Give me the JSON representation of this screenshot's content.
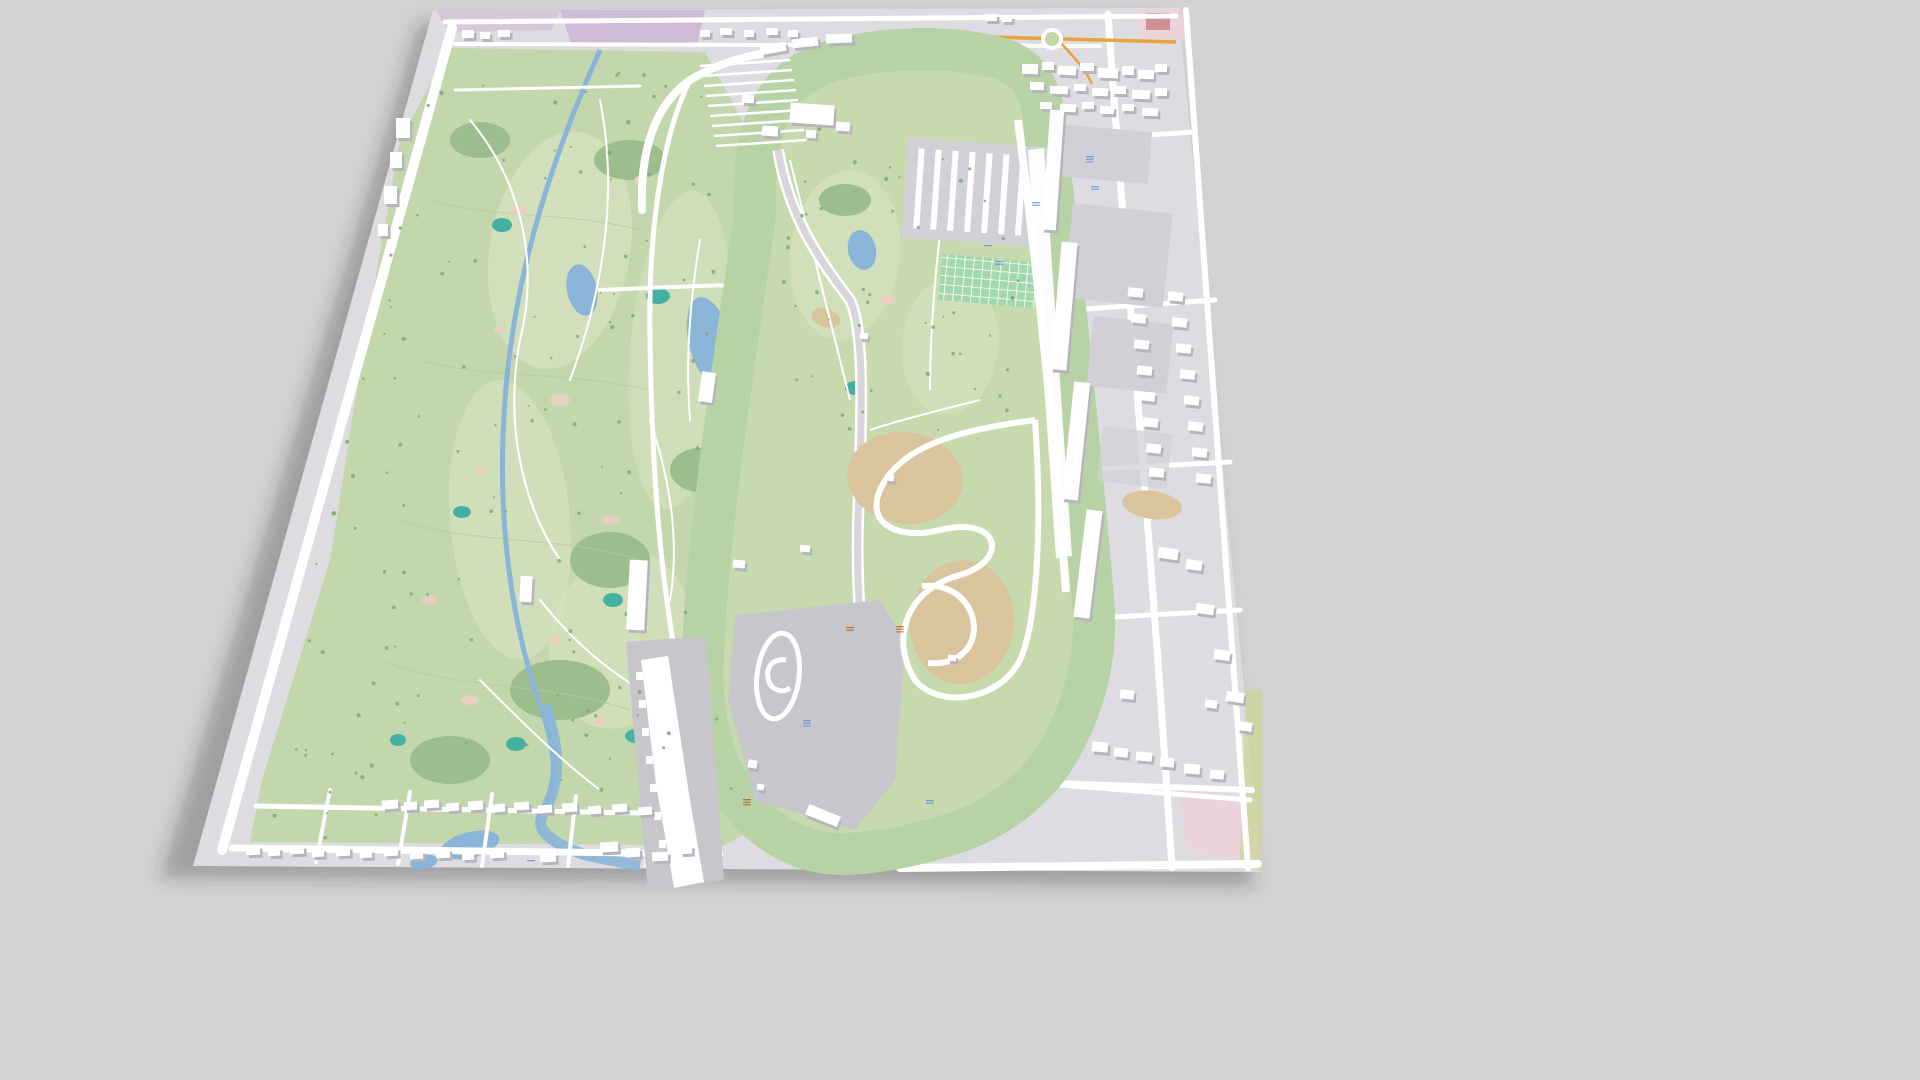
{
  "scene": {
    "title": "3D aerial perspective map — speedway and golf course complex",
    "background": "#d2d2d3"
  },
  "palette": {
    "bg": "#d2d2d3",
    "shadow": "rgba(45,45,50,0.30)",
    "pavement": "#dedce0",
    "pavementDark": "#d2d0d6",
    "paddock": "#c7c6cc",
    "grass": "#c2d7ac",
    "grassLight": "#d6e3bf",
    "grassInfield": "#c6daae",
    "verge": "#b7d2a4",
    "forest": "#9cbd8e",
    "treeGreen": "#7fa878",
    "contour": "#b3caa0",
    "water": "#8ab5d8",
    "teal": "#44b0a2",
    "sand": "#e8d0c0",
    "dirt": "#d9c49e",
    "purple": "#cfbbd5",
    "pinkZone": "#ead3da",
    "redBuilding": "#cf8f93",
    "orangeRoad": "#e8a33d",
    "road": "#ffffff",
    "trackAsphalt": "#d8d6db",
    "buildingTop": "#ffffff",
    "buildingSide": "#b6b5bc",
    "parkingGreen": "#a5d7ae",
    "labelBlue": "#6b8fd4",
    "labelRed": "#b5651d",
    "limeStrip": "#cdd69a"
  },
  "features": {
    "map_plane": "tilted 3d map tile",
    "west_area": "golf course with creek and ponds",
    "center": "oval race track with green verges",
    "infield_north": "infield golf holes and museum buildings",
    "infield_south": "paddock, skid pad and dirt road course",
    "east_area": "parking lots, garages, grandstands and streets",
    "south_area": "residential streets with houses"
  },
  "buildings": [
    {
      "x": 1022,
      "y": 64,
      "w": 16,
      "h": 10,
      "r": 2
    },
    {
      "x": 1042,
      "y": 62,
      "w": 12,
      "h": 8,
      "r": 0
    },
    {
      "x": 1058,
      "y": 66,
      "w": 18,
      "h": 9,
      "r": 3
    },
    {
      "x": 1080,
      "y": 63,
      "w": 14,
      "h": 8,
      "r": 0
    },
    {
      "x": 1098,
      "y": 68,
      "w": 20,
      "h": 10,
      "r": 2
    },
    {
      "x": 1122,
      "y": 66,
      "w": 12,
      "h": 9,
      "r": 0
    },
    {
      "x": 1138,
      "y": 70,
      "w": 16,
      "h": 9,
      "r": 2
    },
    {
      "x": 1155,
      "y": 64,
      "w": 12,
      "h": 8,
      "r": 0
    },
    {
      "x": 1030,
      "y": 82,
      "w": 14,
      "h": 8,
      "r": 1
    },
    {
      "x": 1050,
      "y": 86,
      "w": 18,
      "h": 8,
      "r": 2
    },
    {
      "x": 1074,
      "y": 84,
      "w": 12,
      "h": 7,
      "r": 0
    },
    {
      "x": 1092,
      "y": 88,
      "w": 16,
      "h": 8,
      "r": 2
    },
    {
      "x": 1112,
      "y": 86,
      "w": 14,
      "h": 8,
      "r": 1
    },
    {
      "x": 1132,
      "y": 90,
      "w": 18,
      "h": 9,
      "r": 2
    },
    {
      "x": 1155,
      "y": 88,
      "w": 12,
      "h": 8,
      "r": 0
    },
    {
      "x": 1040,
      "y": 102,
      "w": 12,
      "h": 7,
      "r": 1
    },
    {
      "x": 1060,
      "y": 104,
      "w": 16,
      "h": 8,
      "r": 2
    },
    {
      "x": 1082,
      "y": 102,
      "w": 12,
      "h": 7,
      "r": 0
    },
    {
      "x": 1100,
      "y": 106,
      "w": 14,
      "h": 8,
      "r": 2
    },
    {
      "x": 1122,
      "y": 104,
      "w": 12,
      "h": 7,
      "r": 1
    },
    {
      "x": 1142,
      "y": 108,
      "w": 16,
      "h": 8,
      "r": 2
    },
    {
      "x": 985,
      "y": 14,
      "w": 12,
      "h": 7,
      "r": 0
    },
    {
      "x": 1002,
      "y": 16,
      "w": 10,
      "h": 6,
      "r": 0
    },
    {
      "x": 1128,
      "y": 288,
      "w": 15,
      "h": 9,
      "r": 6
    },
    {
      "x": 1131,
      "y": 314,
      "w": 15,
      "h": 9,
      "r": 6
    },
    {
      "x": 1134,
      "y": 340,
      "w": 15,
      "h": 9,
      "r": 6
    },
    {
      "x": 1137,
      "y": 366,
      "w": 15,
      "h": 9,
      "r": 6
    },
    {
      "x": 1140,
      "y": 392,
      "w": 15,
      "h": 9,
      "r": 6
    },
    {
      "x": 1143,
      "y": 418,
      "w": 15,
      "h": 9,
      "r": 6
    },
    {
      "x": 1146,
      "y": 444,
      "w": 15,
      "h": 9,
      "r": 6
    },
    {
      "x": 1149,
      "y": 468,
      "w": 15,
      "h": 9,
      "r": 6
    },
    {
      "x": 1168,
      "y": 292,
      "w": 15,
      "h": 9,
      "r": 6
    },
    {
      "x": 1172,
      "y": 318,
      "w": 15,
      "h": 9,
      "r": 6
    },
    {
      "x": 1176,
      "y": 344,
      "w": 15,
      "h": 9,
      "r": 6
    },
    {
      "x": 1180,
      "y": 370,
      "w": 15,
      "h": 9,
      "r": 6
    },
    {
      "x": 1184,
      "y": 396,
      "w": 15,
      "h": 9,
      "r": 6
    },
    {
      "x": 1188,
      "y": 422,
      "w": 15,
      "h": 9,
      "r": 6
    },
    {
      "x": 1192,
      "y": 448,
      "w": 15,
      "h": 9,
      "r": 6
    },
    {
      "x": 1196,
      "y": 474,
      "w": 15,
      "h": 9,
      "r": 6
    },
    {
      "x": 1158,
      "y": 548,
      "w": 20,
      "h": 11,
      "r": 8
    },
    {
      "x": 1186,
      "y": 560,
      "w": 16,
      "h": 10,
      "r": 8
    },
    {
      "x": 1196,
      "y": 604,
      "w": 18,
      "h": 10,
      "r": 8
    },
    {
      "x": 1214,
      "y": 650,
      "w": 16,
      "h": 10,
      "r": 8
    },
    {
      "x": 1226,
      "y": 692,
      "w": 18,
      "h": 10,
      "r": 8
    },
    {
      "x": 1238,
      "y": 722,
      "w": 14,
      "h": 9,
      "r": 8
    },
    {
      "x": 1205,
      "y": 700,
      "w": 12,
      "h": 8,
      "r": 8
    },
    {
      "x": 1120,
      "y": 690,
      "w": 14,
      "h": 9,
      "r": 6
    },
    {
      "x": 1092,
      "y": 742,
      "w": 16,
      "h": 10,
      "r": 5
    },
    {
      "x": 1114,
      "y": 748,
      "w": 14,
      "h": 9,
      "r": 5
    },
    {
      "x": 1136,
      "y": 752,
      "w": 16,
      "h": 9,
      "r": 5
    },
    {
      "x": 1160,
      "y": 758,
      "w": 14,
      "h": 9,
      "r": 5
    },
    {
      "x": 1184,
      "y": 764,
      "w": 16,
      "h": 10,
      "r": 5
    },
    {
      "x": 1210,
      "y": 770,
      "w": 14,
      "h": 9,
      "r": 5
    },
    {
      "x": 382,
      "y": 800,
      "w": 16,
      "h": 9,
      "r": -4
    },
    {
      "x": 404,
      "y": 802,
      "w": 13,
      "h": 8,
      "r": -4
    },
    {
      "x": 424,
      "y": 800,
      "w": 15,
      "h": 8,
      "r": -4
    },
    {
      "x": 446,
      "y": 803,
      "w": 13,
      "h": 8,
      "r": -4
    },
    {
      "x": 468,
      "y": 801,
      "w": 15,
      "h": 9,
      "r": -4
    },
    {
      "x": 492,
      "y": 804,
      "w": 13,
      "h": 8,
      "r": -4
    },
    {
      "x": 514,
      "y": 802,
      "w": 15,
      "h": 8,
      "r": -4
    },
    {
      "x": 538,
      "y": 805,
      "w": 14,
      "h": 8,
      "r": -4
    },
    {
      "x": 562,
      "y": 803,
      "w": 15,
      "h": 9,
      "r": -4
    },
    {
      "x": 588,
      "y": 806,
      "w": 13,
      "h": 8,
      "r": -4
    },
    {
      "x": 612,
      "y": 804,
      "w": 15,
      "h": 8,
      "r": -4
    },
    {
      "x": 638,
      "y": 807,
      "w": 14,
      "h": 8,
      "r": -4
    },
    {
      "x": 246,
      "y": 846,
      "w": 14,
      "h": 9,
      "r": -3
    },
    {
      "x": 268,
      "y": 848,
      "w": 12,
      "h": 8,
      "r": -3
    },
    {
      "x": 290,
      "y": 846,
      "w": 14,
      "h": 8,
      "r": -3
    },
    {
      "x": 312,
      "y": 849,
      "w": 12,
      "h": 8,
      "r": -3
    },
    {
      "x": 336,
      "y": 847,
      "w": 14,
      "h": 9,
      "r": -3
    },
    {
      "x": 360,
      "y": 850,
      "w": 12,
      "h": 8,
      "r": -3
    },
    {
      "x": 384,
      "y": 848,
      "w": 14,
      "h": 8,
      "r": -3
    },
    {
      "x": 410,
      "y": 851,
      "w": 13,
      "h": 8,
      "r": -3
    },
    {
      "x": 436,
      "y": 849,
      "w": 14,
      "h": 9,
      "r": -3
    },
    {
      "x": 462,
      "y": 852,
      "w": 12,
      "h": 8,
      "r": -3
    },
    {
      "x": 490,
      "y": 850,
      "w": 14,
      "h": 8,
      "r": -3
    },
    {
      "x": 540,
      "y": 853,
      "w": 16,
      "h": 9,
      "r": -3
    },
    {
      "x": 600,
      "y": 842,
      "w": 18,
      "h": 10,
      "r": -3
    },
    {
      "x": 626,
      "y": 848,
      "w": 14,
      "h": 9,
      "r": -3
    },
    {
      "x": 652,
      "y": 852,
      "w": 16,
      "h": 9,
      "r": -3
    },
    {
      "x": 680,
      "y": 846,
      "w": 12,
      "h": 8,
      "r": -3
    },
    {
      "x": 396,
      "y": 118,
      "w": 14,
      "h": 20,
      "r": 0
    },
    {
      "x": 390,
      "y": 152,
      "w": 12,
      "h": 16,
      "r": 0
    },
    {
      "x": 384,
      "y": 186,
      "w": 13,
      "h": 18,
      "r": 0
    },
    {
      "x": 378,
      "y": 224,
      "w": 10,
      "h": 12,
      "r": 0
    },
    {
      "x": 790,
      "y": 104,
      "w": 44,
      "h": 20,
      "r": 4
    },
    {
      "x": 762,
      "y": 126,
      "w": 16,
      "h": 10,
      "r": 4
    },
    {
      "x": 836,
      "y": 122,
      "w": 14,
      "h": 9,
      "r": 4
    },
    {
      "x": 806,
      "y": 130,
      "w": 10,
      "h": 8,
      "r": 4
    },
    {
      "x": 742,
      "y": 95,
      "w": 12,
      "h": 8,
      "r": 4
    },
    {
      "x": 700,
      "y": 372,
      "w": 14,
      "h": 30,
      "r": 8
    },
    {
      "x": 733,
      "y": 560,
      "w": 12,
      "h": 8,
      "r": 5
    },
    {
      "x": 860,
      "y": 333,
      "w": 8,
      "h": 6,
      "r": 5
    },
    {
      "x": 885,
      "y": 475,
      "w": 9,
      "h": 6,
      "r": 5
    },
    {
      "x": 800,
      "y": 545,
      "w": 10,
      "h": 7,
      "r": 5
    },
    {
      "x": 948,
      "y": 655,
      "w": 8,
      "h": 6,
      "r": 5
    },
    {
      "x": 748,
      "y": 760,
      "w": 9,
      "h": 8,
      "r": 10
    },
    {
      "x": 757,
      "y": 784,
      "w": 7,
      "h": 6,
      "r": 10
    },
    {
      "x": 806,
      "y": 810,
      "w": 34,
      "h": 11,
      "r": 22
    },
    {
      "x": 462,
      "y": 30,
      "w": 12,
      "h": 8,
      "r": 0
    },
    {
      "x": 480,
      "y": 32,
      "w": 10,
      "h": 7,
      "r": 0
    },
    {
      "x": 498,
      "y": 30,
      "w": 12,
      "h": 7,
      "r": 0
    },
    {
      "x": 700,
      "y": 30,
      "w": 10,
      "h": 7,
      "r": 0
    },
    {
      "x": 720,
      "y": 28,
      "w": 12,
      "h": 7,
      "r": 0
    },
    {
      "x": 744,
      "y": 30,
      "w": 10,
      "h": 7,
      "r": 0
    },
    {
      "x": 766,
      "y": 28,
      "w": 12,
      "h": 7,
      "r": 0
    },
    {
      "x": 788,
      "y": 30,
      "w": 10,
      "h": 7,
      "r": 0
    },
    {
      "x": 760,
      "y": 44,
      "w": 26,
      "h": 9,
      "r": -10
    },
    {
      "x": 792,
      "y": 38,
      "w": 26,
      "h": 9,
      "r": -6
    },
    {
      "x": 826,
      "y": 34,
      "w": 26,
      "h": 9,
      "r": -2
    },
    {
      "x": 1046,
      "y": 110,
      "w": 14,
      "h": 120,
      "r": 4
    },
    {
      "x": 1056,
      "y": 242,
      "w": 16,
      "h": 128,
      "r": 5
    },
    {
      "x": 1068,
      "y": 382,
      "w": 16,
      "h": 118,
      "r": 6
    },
    {
      "x": 1080,
      "y": 510,
      "w": 16,
      "h": 108,
      "r": 7
    },
    {
      "x": 628,
      "y": 560,
      "w": 18,
      "h": 70,
      "r": 3
    },
    {
      "x": 520,
      "y": 576,
      "w": 12,
      "h": 26,
      "r": 3
    }
  ],
  "markers": [
    {
      "x": 807,
      "y": 720,
      "color": "blue",
      "lines": 3
    },
    {
      "x": 1090,
      "y": 156,
      "color": "blue",
      "lines": 3
    },
    {
      "x": 1095,
      "y": 186,
      "color": "blue",
      "lines": 2
    },
    {
      "x": 1036,
      "y": 202,
      "color": "blue",
      "lines": 2
    },
    {
      "x": 988,
      "y": 245,
      "color": "blue",
      "lines": 1
    },
    {
      "x": 999,
      "y": 261,
      "color": "blue",
      "lines": 2
    },
    {
      "x": 930,
      "y": 800,
      "color": "blue",
      "lines": 2
    },
    {
      "x": 531,
      "y": 860,
      "color": "blue",
      "lines": 1
    },
    {
      "x": 747,
      "y": 799,
      "color": "red",
      "lines": 3
    },
    {
      "x": 850,
      "y": 627,
      "color": "red",
      "lines": 2
    },
    {
      "x": 900,
      "y": 626,
      "color": "red",
      "lines": 3
    }
  ],
  "trees": {
    "seed": 7,
    "west_count": 130,
    "infield_count": 48
  }
}
